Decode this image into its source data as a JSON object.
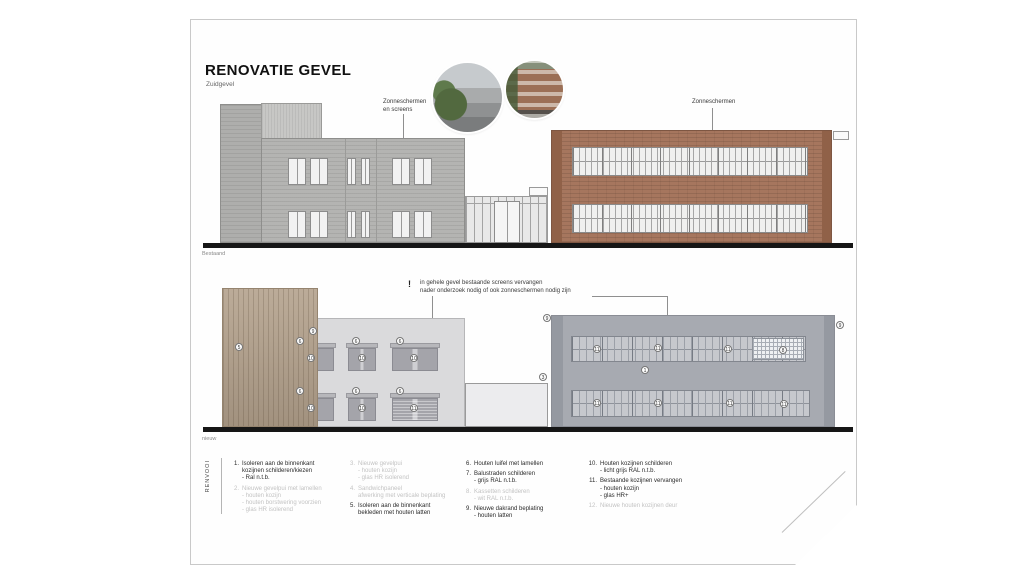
{
  "sheet": {
    "title": "RENOVATIE GEVEL",
    "subtitle": "Zuidgevel"
  },
  "labels": {
    "top_screens_line1": "Zonneschermen",
    "top_screens_line2": "en screens",
    "top_right_screens": "Zonneschermen",
    "elevation_top_caption": "Bestaand",
    "elevation_bottom_caption": "nieuw",
    "note_mark": "!",
    "note_line1": "in gehele gevel bestaande screens vervangen",
    "note_line2": "nader onderzoek nodig of ook zonneschermen nodig zijn",
    "legend_heading": "RENVOOI"
  },
  "legend": {
    "columns": [
      [
        {
          "num": "1.",
          "active": true,
          "lines": [
            "Isoleren aan de binnenkant",
            "kozijnen schilderen/kiezen",
            "- Ral n.t.b."
          ]
        },
        {
          "num": "2.",
          "active": false,
          "lines": [
            "Nieuwe gevelpui met lamellen",
            "- houten kozijn",
            "- houten borstwering voorzien",
            "- glas HR isolerend"
          ]
        }
      ],
      [
        {
          "num": "3.",
          "active": false,
          "lines": [
            "Nieuwe gevelpui",
            "- houten kozijn",
            "- glas HR isolerend"
          ]
        },
        {
          "num": "4.",
          "active": false,
          "lines": [
            "Sandwichpaneel",
            "afwerking met verticale beplating"
          ]
        },
        {
          "num": "5.",
          "active": true,
          "lines": [
            "Isoleren aan de binnenkant",
            "bekleden met houten latten"
          ]
        }
      ],
      [
        {
          "num": "6.",
          "active": true,
          "lines": [
            "Houten luifel met lamellen"
          ]
        },
        {
          "num": "7.",
          "active": true,
          "lines": [
            "Balustraden schilderen",
            "- grijs RAL n.t.b."
          ]
        },
        {
          "num": "8.",
          "active": false,
          "lines": [
            "Kassetten schilderen",
            "- wit RAL n.t.b."
          ]
        },
        {
          "num": "9.",
          "active": true,
          "lines": [
            "Nieuwe dakrand beplating",
            "- houten latten"
          ]
        }
      ],
      [
        {
          "num": "10.",
          "active": true,
          "lines": [
            "Houten kozijnen schilderen",
            "- licht grijs RAL n.t.b."
          ]
        },
        {
          "num": "11.",
          "active": true,
          "lines": [
            "Bestaande kozijnen vervangen",
            "- houten kozijn",
            "- glas HR+"
          ]
        },
        {
          "num": "12.",
          "active": false,
          "lines": [
            "Nieuwe houten kozijnen deur"
          ]
        }
      ]
    ]
  },
  "drawing": {
    "markers": [
      {
        "n": "9",
        "x": 313,
        "y": 331
      },
      {
        "n": "5",
        "x": 239,
        "y": 347
      },
      {
        "n": "6",
        "x": 300,
        "y": 341
      },
      {
        "n": "10",
        "x": 311,
        "y": 358
      },
      {
        "n": "6",
        "x": 356,
        "y": 341
      },
      {
        "n": "10",
        "x": 362,
        "y": 358
      },
      {
        "n": "6",
        "x": 400,
        "y": 341
      },
      {
        "n": "10",
        "x": 414,
        "y": 358
      },
      {
        "n": "6",
        "x": 300,
        "y": 391
      },
      {
        "n": "10",
        "x": 311,
        "y": 408
      },
      {
        "n": "6",
        "x": 356,
        "y": 391
      },
      {
        "n": "10",
        "x": 362,
        "y": 408
      },
      {
        "n": "6",
        "x": 400,
        "y": 391
      },
      {
        "n": "11",
        "x": 414,
        "y": 408
      },
      {
        "n": "9",
        "x": 547,
        "y": 318
      },
      {
        "n": "9",
        "x": 840,
        "y": 325
      },
      {
        "n": "3",
        "x": 543,
        "y": 377
      },
      {
        "n": "11",
        "x": 597,
        "y": 349
      },
      {
        "n": "11",
        "x": 658,
        "y": 348
      },
      {
        "n": "11",
        "x": 728,
        "y": 349
      },
      {
        "n": "8",
        "x": 783,
        "y": 350
      },
      {
        "n": "1",
        "x": 645,
        "y": 370
      },
      {
        "n": "11",
        "x": 597,
        "y": 403
      },
      {
        "n": "11",
        "x": 658,
        "y": 403
      },
      {
        "n": "11",
        "x": 730,
        "y": 403
      },
      {
        "n": "11",
        "x": 784,
        "y": 404
      }
    ]
  },
  "colors": {
    "brick": "#a6765e",
    "grey_brick": "#b4b4b2",
    "wood_cladding": "#b4a28d",
    "new_facade_grey": "#dadadc",
    "new_right_grey": "#a7aab1",
    "ground_line": "#161616",
    "inactive_legend": "#c3c3c3"
  }
}
